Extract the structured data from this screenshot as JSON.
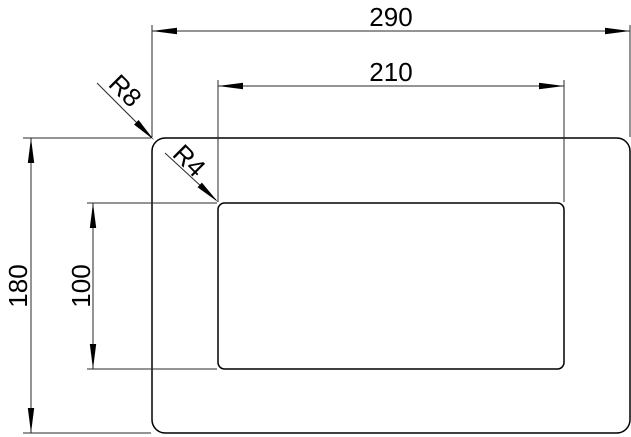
{
  "drawing": {
    "background": "#ffffff",
    "line_color": "#000000",
    "outer_rectangle": {
      "width_label": "290",
      "height_label": "180",
      "corner_radius_label": "R8"
    },
    "inner_rectangle": {
      "width_label": "210",
      "height_label": "100",
      "corner_radius_label": "R4"
    }
  }
}
